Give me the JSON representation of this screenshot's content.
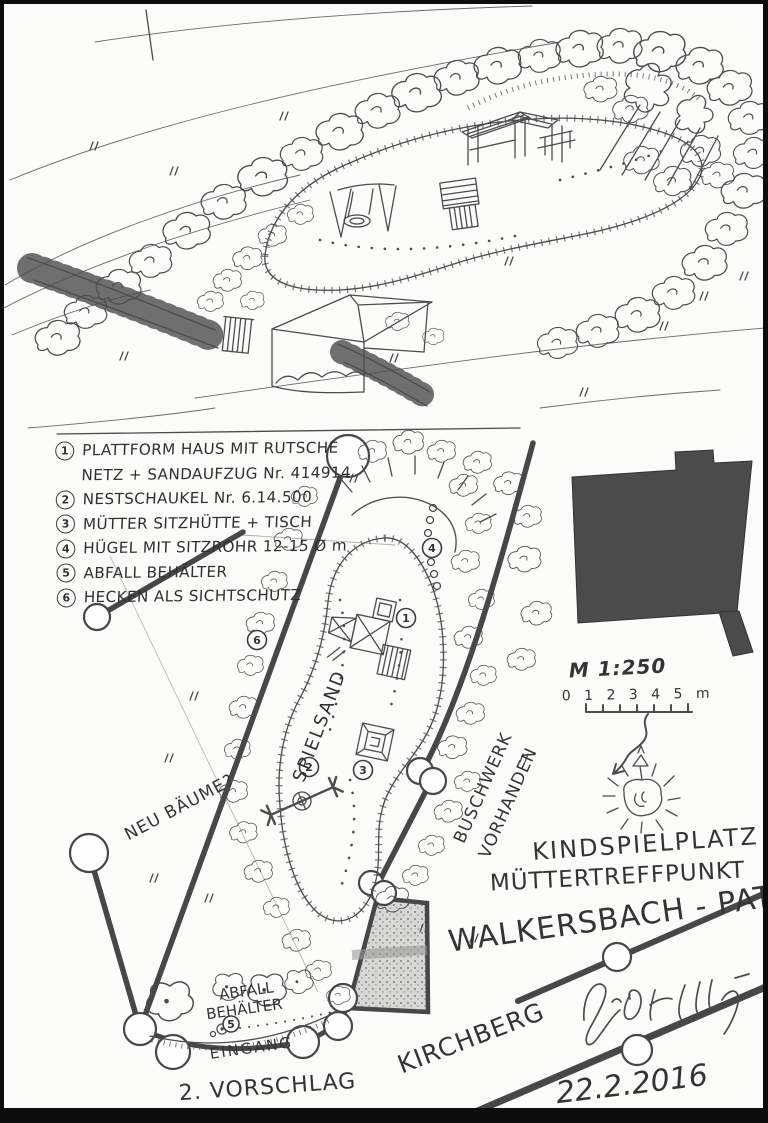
{
  "page": {
    "background": "#fbfbfa",
    "ink_color": "#4c4c4c",
    "frame_color": "#0d0d0d"
  },
  "legend": {
    "rows": [
      {
        "num": "1",
        "label": "PLATTFORM HAUS MIT RUTSCHE"
      },
      {
        "num": "",
        "label": "NETZ + SANDAUFZUG Nr. 414914"
      },
      {
        "num": "2",
        "label": "NESTSCHAUKEL Nr. 6.14.500"
      },
      {
        "num": "3",
        "label": "MÜTTER SITZHÜTTE + TISCH"
      },
      {
        "num": "4",
        "label": "HÜGEL MIT SITZROHR 12-15 Ø m"
      },
      {
        "num": "5",
        "label": "ABFALL BEHÄLTER"
      },
      {
        "num": "6",
        "label": "HECKEN ALS SICHTSCHUTZ"
      }
    ]
  },
  "plan": {
    "labels": {
      "sand": "SPIELSAND",
      "new_trees": "NEU BÄUME?",
      "bushes_line1": "BUSCHWERK",
      "bushes_line2": "VORHANDEN",
      "bin_line1": "ABFALL",
      "bin_line2": "BEHÄLTER",
      "entrance": "EINGANG",
      "street": "KIRCHBERG"
    },
    "markers": [
      "1",
      "2",
      "3",
      "4",
      "5",
      "6"
    ],
    "scale": {
      "ratio": "M 1:250",
      "ticks": "0 1 2 3 4 5 m"
    },
    "compass": {
      "label": "N"
    }
  },
  "titles": {
    "line1": "KINDSPIELPLATZ",
    "line2": "MÜTTERTREFFPUNKT",
    "line3": "WALKERSBACH - PAT",
    "proposal": "2. VORSCHLAG",
    "date": "22.2.2016",
    "signature": "Günt Bettig"
  }
}
